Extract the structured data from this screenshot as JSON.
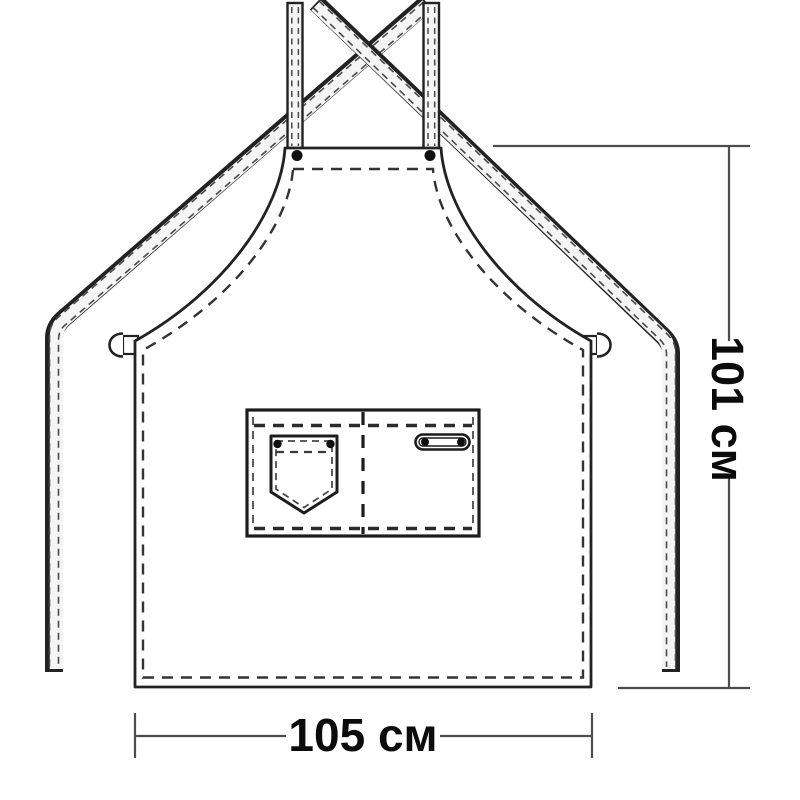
{
  "document": {
    "type": "apron-sewing-schematic",
    "background": "#ffffff"
  },
  "dimensions": {
    "height": {
      "label": "101 см",
      "value": 101,
      "unit": "см",
      "orientation": "vertical"
    },
    "width": {
      "label": "105 см",
      "value": 105,
      "unit": "см",
      "orientation": "horizontal"
    }
  },
  "colors": {
    "ink": "#222222",
    "stitch": "#4a4a4a",
    "dimension_line": "#4d4d4d",
    "label_text": "#0b0b0b",
    "strap_fill": "#f5f5f5",
    "rivet": "#101010"
  },
  "parts": [
    "crossed-shoulder-straps",
    "neck-rivets",
    "bib",
    "armholes",
    "waist-ties",
    "side-rings",
    "pocket-panel",
    "chest-pocket",
    "pocket-rivets",
    "tool-loop",
    "hem-stitching"
  ]
}
